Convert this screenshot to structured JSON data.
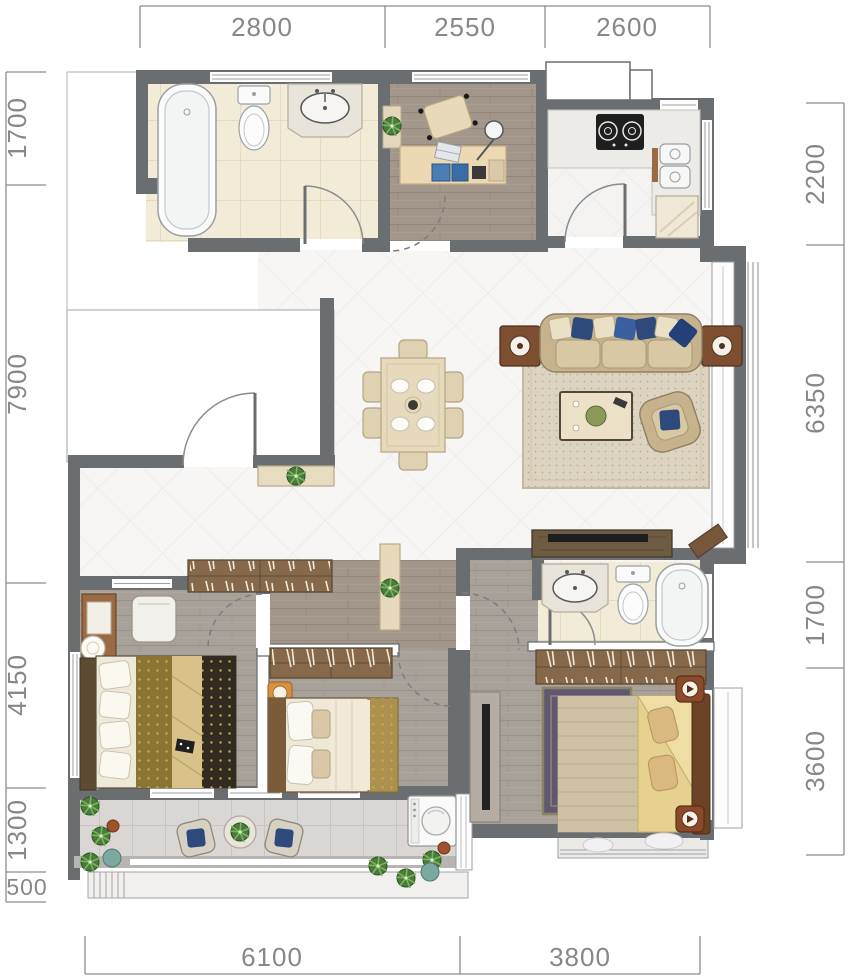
{
  "plan": {
    "dims": {
      "top": [
        "2800",
        "2550",
        "2600"
      ],
      "left": [
        "1700",
        "7900",
        "4150",
        "1300",
        "500"
      ],
      "right": [
        "2200",
        "6350",
        "1700",
        "3600"
      ],
      "bottom": [
        "6100",
        "3800"
      ]
    },
    "colors": {
      "wall": "#6b6e71",
      "bath_tile": "#f1ebd8",
      "wood_warm": "#a3968a",
      "wood_gray": "#a7a099",
      "marble": "#f7f6f5",
      "balcony_tile": "#d9d6d3",
      "navy_cushion": "#2e4a7c",
      "beige_furniture": "#e6d8ba",
      "cabinet_wood": "#86694b",
      "dim_text": "#85888b"
    },
    "icons": {
      "bathtub-icon": "rounded-rect-with-inner-oval",
      "toilet-icon": "tank-with-oval-bowl",
      "basin-icon": "counter-with-oval-sink",
      "stove-icon": "black-rect-two-burners",
      "kitchen-sink-icon": "double-basin-squares",
      "fridge-icon": "square-with-diagonals",
      "dining-set-icon": "table-with-six-chairs",
      "sofa-icon": "three-seat-sofa-with-pillows",
      "coffee-table-icon": "rect-table-with-decor",
      "armchair-icon": "rotated-single-seat",
      "side-table-icon": "square-with-round-lamp",
      "tv-console-icon": "long-cabinet-with-tv-bar",
      "wardrobe-icon": "cabinet-with-hangers",
      "bed-icon": "double-bed-top-view",
      "nightstand-icon": "small-side-table",
      "desk-icon": "writing-desk-with-chair",
      "washing-machine-icon": "square-with-drum-circle",
      "plant-icon": "leaf-starburst",
      "door-icon": "quarter-arc-swing",
      "window-icon": "double-line-band"
    }
  }
}
